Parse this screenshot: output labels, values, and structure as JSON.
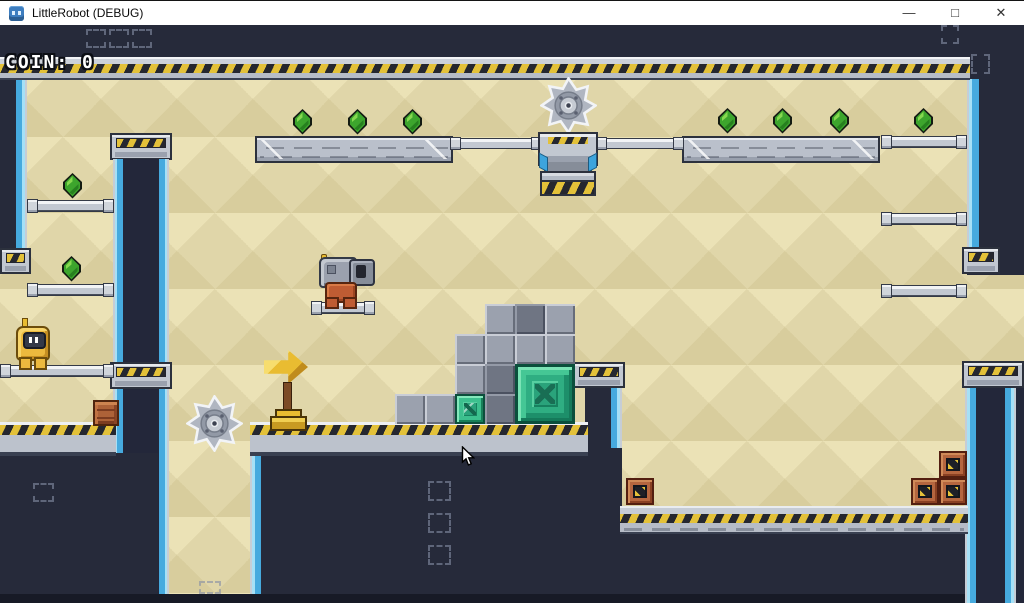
{
  "window": {
    "title": "LittleRobot (DEBUG)",
    "controls": {
      "minimize": "—",
      "maximize": "□",
      "close": "✕"
    }
  },
  "hud": {
    "coin_label": "COIN:",
    "coin_value": "0"
  },
  "palette": {
    "background_navy": "#262a3a",
    "bottom_strip": "#171a26",
    "sand_light": "#ebe2b6",
    "sand_dark": "#d8cd9d",
    "hazard_yellow": "#e3c139",
    "hazard_black": "#25272f",
    "metal_light": "#c2c8d1",
    "metal_outline": "#2c313d",
    "edge_blue": "#46aade",
    "gem_green": "#3da52d",
    "emerald": "#2fae82",
    "gold": "#e9bc31",
    "crate_brown": "#ad6238",
    "robot_yellow": "#ecb93e",
    "enemy_rust": "#bf5c33"
  },
  "level": {
    "entities": [
      {
        "type": "dark",
        "name": "hud-band",
        "x": 0,
        "y": 24,
        "w": 1024,
        "h": 34
      },
      {
        "type": "tan",
        "name": "play-field",
        "x": 0,
        "y": 58,
        "w": 1024,
        "h": 537
      },
      {
        "type": "dark",
        "name": "left-wall",
        "x": 0,
        "y": 76,
        "w": 27,
        "h": 174
      },
      {
        "type": "edge-strip-r",
        "name": "left-wall-edge",
        "x": 16,
        "y": 76,
        "w": 11,
        "h": 174
      },
      {
        "type": "dark",
        "name": "right-wall",
        "x": 967,
        "y": 24,
        "w": 57,
        "h": 250
      },
      {
        "type": "edge-strip-l",
        "name": "right-wall-edge",
        "x": 967,
        "y": 78,
        "w": 12,
        "h": 170
      },
      {
        "type": "col-cap",
        "name": "column-a-top-cap",
        "x": 110,
        "y": 132,
        "w": 62,
        "h": 27
      },
      {
        "type": "vcol",
        "name": "column-a-upper",
        "x": 113,
        "y": 158,
        "w": 56,
        "h": 206
      },
      {
        "type": "col-cap",
        "name": "column-a-mid-cap",
        "x": 110,
        "y": 361,
        "w": 62,
        "h": 27
      },
      {
        "type": "vcol",
        "name": "column-a-lower",
        "x": 113,
        "y": 388,
        "w": 56,
        "h": 205
      },
      {
        "type": "dark",
        "name": "center-wall",
        "x": 585,
        "y": 385,
        "w": 37,
        "h": 206
      },
      {
        "type": "edge-strip-r",
        "name": "center-wall-edge",
        "x": 611,
        "y": 385,
        "w": 11,
        "h": 206
      },
      {
        "type": "col-cap",
        "name": "center-wall-cap",
        "x": 573,
        "y": 361,
        "w": 52,
        "h": 26
      },
      {
        "type": "dark",
        "name": "left-pit",
        "x": 0,
        "y": 452,
        "w": 158,
        "h": 141
      },
      {
        "type": "dark",
        "name": "center-pit",
        "x": 250,
        "y": 447,
        "w": 372,
        "h": 146
      },
      {
        "type": "edge-strip-l",
        "name": "center-pit-edge",
        "x": 250,
        "y": 450,
        "w": 11,
        "h": 143
      },
      {
        "type": "dark",
        "name": "right-pit",
        "x": 620,
        "y": 531,
        "w": 348,
        "h": 62
      },
      {
        "type": "col-cap",
        "name": "column-b-cap",
        "x": 962,
        "y": 360,
        "w": 62,
        "h": 27
      },
      {
        "type": "vcol-b",
        "name": "column-b",
        "x": 965,
        "y": 387,
        "w": 59,
        "h": 216
      },
      {
        "type": "dark2",
        "name": "bottom-strip",
        "x": 0,
        "y": 593,
        "w": 965,
        "h": 10
      },
      {
        "type": "col-cap",
        "name": "left-wall-cap",
        "x": 0,
        "y": 247,
        "w": 31,
        "h": 26
      },
      {
        "type": "col-cap",
        "name": "right-wall-bracket",
        "x": 962,
        "y": 246,
        "w": 38,
        "h": 27
      },
      {
        "type": "hazard-top",
        "name": "top-hazard-bar",
        "x": 0,
        "y": 56,
        "w": 970,
        "h": 23
      },
      {
        "type": "big-platform",
        "name": "metal-platform-left",
        "x": 255,
        "y": 135,
        "w": 198,
        "h": 27
      },
      {
        "type": "big-platform",
        "name": "metal-platform-right",
        "x": 682,
        "y": 135,
        "w": 198,
        "h": 27
      },
      {
        "type": "rail",
        "name": "rail-crusher-left",
        "x": 450,
        "y": 137,
        "w": 92,
        "h": 11
      },
      {
        "type": "rail",
        "name": "rail-crusher-right",
        "x": 596,
        "y": 137,
        "w": 88,
        "h": 11
      },
      {
        "type": "rail",
        "name": "rail-top-right",
        "x": 881,
        "y": 135,
        "w": 86,
        "h": 12
      },
      {
        "type": "rail",
        "name": "rail-left-1",
        "x": 27,
        "y": 199,
        "w": 87,
        "h": 12
      },
      {
        "type": "rail",
        "name": "rail-left-2",
        "x": 27,
        "y": 283,
        "w": 87,
        "h": 12
      },
      {
        "type": "rail",
        "name": "rail-right-1",
        "x": 881,
        "y": 212,
        "w": 86,
        "h": 12
      },
      {
        "type": "rail",
        "name": "rail-right-2",
        "x": 881,
        "y": 284,
        "w": 86,
        "h": 12
      },
      {
        "type": "rail",
        "name": "rail-player",
        "x": 0,
        "y": 364,
        "w": 114,
        "h": 12
      },
      {
        "type": "rail",
        "name": "rail-enemy",
        "x": 311,
        "y": 301,
        "w": 64,
        "h": 12
      },
      {
        "type": "ground-bar",
        "name": "ground-left",
        "x": 0,
        "y": 421,
        "w": 116,
        "h": 34
      },
      {
        "type": "ground-bar",
        "name": "ground-center",
        "x": 250,
        "y": 421,
        "w": 338,
        "h": 34
      },
      {
        "type": "ground-low",
        "name": "ground-right",
        "x": 620,
        "y": 505,
        "w": 348,
        "h": 28
      },
      {
        "type": "saw",
        "name": "saw-blade-top",
        "x": 540,
        "y": 76,
        "w": 57,
        "h": 57
      },
      {
        "type": "crusher",
        "name": "crusher-press",
        "x": 536,
        "y": 131,
        "w": 64,
        "h": 60
      },
      {
        "type": "blk-g",
        "name": "metal-block",
        "x": 485,
        "y": 303,
        "w": 30,
        "h": 30
      },
      {
        "type": "blk-gd",
        "name": "metal-block-dark",
        "x": 515,
        "y": 303,
        "w": 30,
        "h": 30
      },
      {
        "type": "blk-g",
        "name": "metal-block",
        "x": 545,
        "y": 303,
        "w": 30,
        "h": 30
      },
      {
        "type": "blk-g",
        "name": "metal-block",
        "x": 455,
        "y": 333,
        "w": 30,
        "h": 30
      },
      {
        "type": "blk-g",
        "name": "metal-block",
        "x": 485,
        "y": 333,
        "w": 30,
        "h": 30
      },
      {
        "type": "blk-g",
        "name": "metal-block",
        "x": 515,
        "y": 333,
        "w": 30,
        "h": 30
      },
      {
        "type": "blk-g",
        "name": "metal-block",
        "x": 545,
        "y": 333,
        "w": 30,
        "h": 30
      },
      {
        "type": "blk-g",
        "name": "metal-block",
        "x": 455,
        "y": 363,
        "w": 30,
        "h": 30
      },
      {
        "type": "blk-gd",
        "name": "metal-block-dark",
        "x": 485,
        "y": 363,
        "w": 30,
        "h": 30
      },
      {
        "type": "blk-g",
        "name": "metal-block",
        "x": 395,
        "y": 393,
        "w": 30,
        "h": 30
      },
      {
        "type": "blk-g",
        "name": "metal-block",
        "x": 425,
        "y": 393,
        "w": 30,
        "h": 30
      },
      {
        "type": "blk-es",
        "name": "emerald-block-small",
        "x": 455,
        "y": 393,
        "w": 30,
        "h": 30
      },
      {
        "type": "blk-gd",
        "name": "metal-block-dark",
        "x": 485,
        "y": 393,
        "w": 30,
        "h": 30
      },
      {
        "type": "blk-em",
        "name": "emerald-block-large",
        "x": 515,
        "y": 363,
        "w": 60,
        "h": 60
      },
      {
        "type": "signpost",
        "name": "arrow-signpost",
        "x": 264,
        "y": 349,
        "w": 45,
        "h": 77
      },
      {
        "type": "crate-w",
        "name": "wooden-crate",
        "x": 93,
        "y": 399,
        "w": 26,
        "h": 26
      },
      {
        "type": "crate-h",
        "name": "hazard-crate",
        "x": 626,
        "y": 477,
        "w": 28,
        "h": 27
      },
      {
        "type": "crate-h",
        "name": "hazard-crate",
        "x": 911,
        "y": 477,
        "w": 28,
        "h": 27
      },
      {
        "type": "crate-h",
        "name": "hazard-crate",
        "x": 939,
        "y": 477,
        "w": 28,
        "h": 27
      },
      {
        "type": "crate-h",
        "name": "hazard-crate",
        "x": 939,
        "y": 450,
        "w": 28,
        "h": 27
      },
      {
        "type": "gem",
        "name": "gem",
        "x": 62,
        "y": 172,
        "w": 21,
        "h": 26
      },
      {
        "type": "gem",
        "name": "gem",
        "x": 61,
        "y": 255,
        "w": 21,
        "h": 26
      },
      {
        "type": "gem",
        "name": "gem",
        "x": 292,
        "y": 108,
        "w": 21,
        "h": 26
      },
      {
        "type": "gem",
        "name": "gem",
        "x": 347,
        "y": 108,
        "w": 21,
        "h": 26
      },
      {
        "type": "gem",
        "name": "gem",
        "x": 402,
        "y": 108,
        "w": 21,
        "h": 26
      },
      {
        "type": "gem",
        "name": "gem",
        "x": 717,
        "y": 107,
        "w": 21,
        "h": 26
      },
      {
        "type": "gem",
        "name": "gem",
        "x": 772,
        "y": 107,
        "w": 21,
        "h": 26
      },
      {
        "type": "gem",
        "name": "gem",
        "x": 829,
        "y": 107,
        "w": 21,
        "h": 26
      },
      {
        "type": "gem",
        "name": "gem",
        "x": 913,
        "y": 107,
        "w": 21,
        "h": 26
      },
      {
        "type": "player",
        "name": "player-robot",
        "x": 15,
        "y": 317,
        "w": 34,
        "h": 49
      },
      {
        "type": "enemy",
        "name": "cannon-enemy",
        "x": 313,
        "y": 253,
        "w": 60,
        "h": 52
      },
      {
        "type": "saw",
        "name": "saw-blade-lower",
        "x": 186,
        "y": 394,
        "w": 57,
        "h": 57
      },
      {
        "type": "bracket",
        "name": "debug-marker",
        "x": 86,
        "y": 28,
        "w": 20,
        "h": 19
      },
      {
        "type": "bracket",
        "name": "debug-marker",
        "x": 109,
        "y": 28,
        "w": 20,
        "h": 19
      },
      {
        "type": "bracket",
        "name": "debug-marker",
        "x": 132,
        "y": 28,
        "w": 20,
        "h": 19
      },
      {
        "type": "bracket",
        "name": "debug-marker",
        "x": 941,
        "y": 24,
        "w": 18,
        "h": 19
      },
      {
        "type": "bracket",
        "name": "debug-marker",
        "x": 971,
        "y": 53,
        "w": 19,
        "h": 20
      },
      {
        "type": "bracket",
        "name": "debug-marker",
        "x": 33,
        "y": 482,
        "w": 21,
        "h": 19
      },
      {
        "type": "bracket",
        "name": "debug-marker",
        "x": 428,
        "y": 480,
        "w": 23,
        "h": 20
      },
      {
        "type": "bracket",
        "name": "debug-marker",
        "x": 428,
        "y": 512,
        "w": 23,
        "h": 20
      },
      {
        "type": "bracket",
        "name": "debug-marker",
        "x": 428,
        "y": 544,
        "w": 23,
        "h": 20
      },
      {
        "type": "bracket",
        "name": "debug-marker",
        "x": 199,
        "y": 580,
        "w": 22,
        "h": 13
      },
      {
        "type": "cursor",
        "name": "mouse-cursor",
        "x": 461,
        "y": 445,
        "w": 14,
        "h": 21
      }
    ]
  }
}
